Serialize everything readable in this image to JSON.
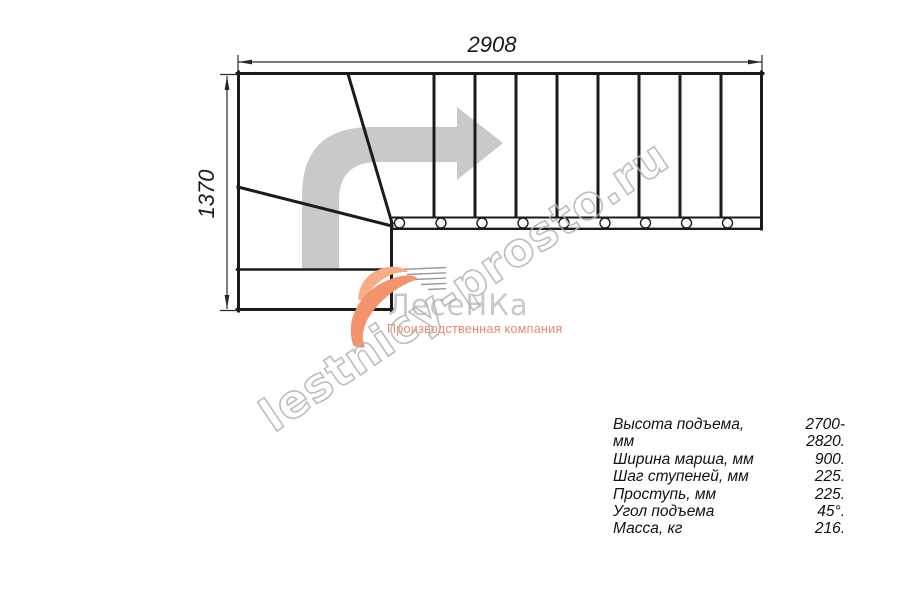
{
  "dimensions": {
    "width_mm": "2908",
    "height_mm": "1370"
  },
  "watermark": {
    "text": "lestnicy-prosto.ru"
  },
  "logo": {
    "name": "ЛесеНКа",
    "tagline": "Производственная компания"
  },
  "specs": {
    "rows": [
      {
        "label": "Высота подъема, мм",
        "value": "2700-2820."
      },
      {
        "label": "Ширина марша, мм",
        "value": "900."
      },
      {
        "label": "Шаг ступеней, мм",
        "value": "225."
      },
      {
        "label": "Проступь, мм",
        "value": "225."
      },
      {
        "label": "Угол подъема",
        "value": "45°."
      },
      {
        "label": "Масса, кг",
        "value": "216."
      }
    ]
  },
  "colors": {
    "line": "#1b1b1b",
    "direction_arrow": "#c9c9c9",
    "watermark_outline": "#b2b2b2",
    "logo_text": "#c9c9c9",
    "logo_tagline": "#ee8372",
    "logo_swoosh": "#f2936b",
    "background": "#ffffff"
  }
}
